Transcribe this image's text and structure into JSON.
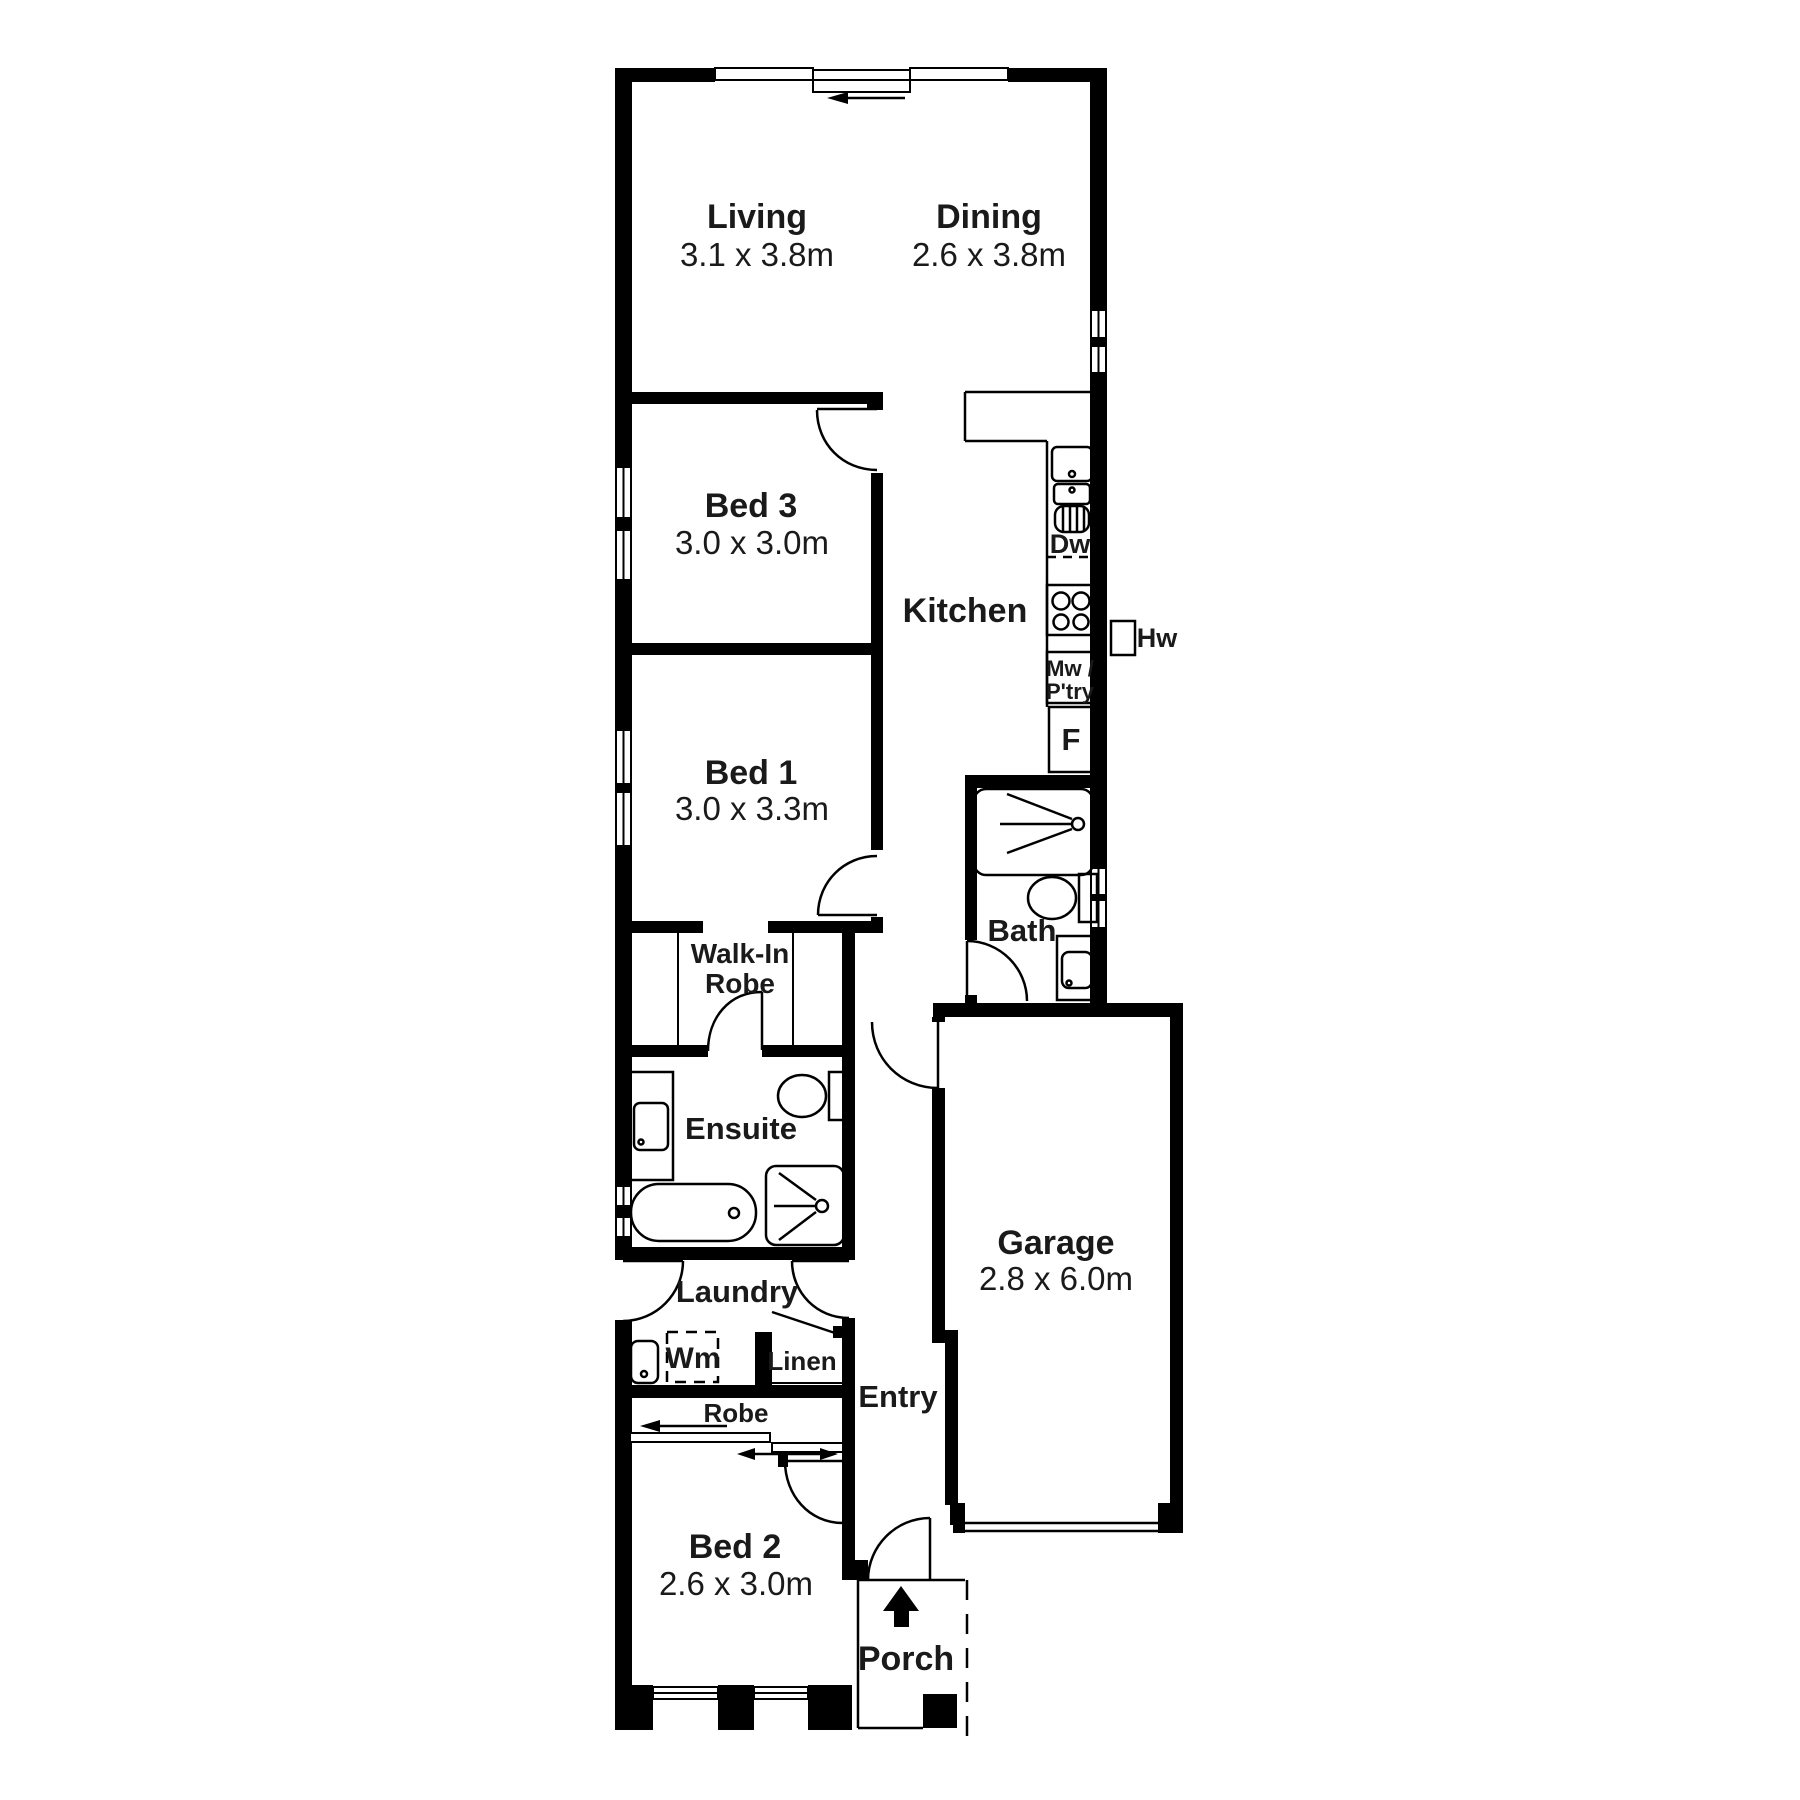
{
  "document": {
    "type": "floor-plan",
    "background": "#ffffff",
    "wall_color": "#000000",
    "text_color": "#1a1a1a"
  },
  "rooms": [
    {
      "name": "Living",
      "dimensions": "3.1 x 3.8m"
    },
    {
      "name": "Dining",
      "dimensions": "2.6 x 3.8m"
    },
    {
      "name": "Bed 3",
      "dimensions": "3.0 x 3.0m"
    },
    {
      "name": "Kitchen",
      "dimensions": ""
    },
    {
      "name": "Bed 1",
      "dimensions": "3.0 x 3.3m"
    },
    {
      "name": "Walk-In Robe",
      "dimensions": ""
    },
    {
      "name": "Bath",
      "dimensions": ""
    },
    {
      "name": "Ensuite",
      "dimensions": ""
    },
    {
      "name": "Garage",
      "dimensions": "2.8 x 6.0m"
    },
    {
      "name": "Laundry",
      "dimensions": ""
    },
    {
      "name": "Linen",
      "dimensions": ""
    },
    {
      "name": "Entry",
      "dimensions": ""
    },
    {
      "name": "Bed 2",
      "dimensions": "2.6 x 3.0m"
    },
    {
      "name": "Porch",
      "dimensions": ""
    }
  ],
  "fixture_labels": {
    "dishwasher": "Dw",
    "microwave_pantry": "Mw / P'try",
    "fridge": "F",
    "hot_water": "Hw",
    "washing_machine": "Wm",
    "robe": "Robe"
  },
  "labels": [
    {
      "id": "living-name",
      "text": "Living",
      "x": 757,
      "y": 228,
      "size": 34,
      "weight": 700
    },
    {
      "id": "living-dims",
      "text": "3.1 x 3.8m",
      "x": 757,
      "y": 266,
      "size": 33,
      "weight": 400
    },
    {
      "id": "dining-name",
      "text": "Dining",
      "x": 989,
      "y": 228,
      "size": 34,
      "weight": 700
    },
    {
      "id": "dining-dims",
      "text": "2.6 x 3.8m",
      "x": 989,
      "y": 266,
      "size": 33,
      "weight": 400
    },
    {
      "id": "bed3-name",
      "text": "Bed 3",
      "x": 751,
      "y": 517,
      "size": 34,
      "weight": 700
    },
    {
      "id": "bed3-dims",
      "text": "3.0 x 3.0m",
      "x": 752,
      "y": 554,
      "size": 33,
      "weight": 400
    },
    {
      "id": "kitchen-name",
      "text": "Kitchen",
      "x": 965,
      "y": 622,
      "size": 34,
      "weight": 700
    },
    {
      "id": "bed1-name",
      "text": "Bed 1",
      "x": 751,
      "y": 784,
      "size": 34,
      "weight": 700
    },
    {
      "id": "bed1-dims",
      "text": "3.0 x 3.3m",
      "x": 752,
      "y": 820,
      "size": 33,
      "weight": 400
    },
    {
      "id": "wir-line1",
      "text": "Walk-In",
      "x": 740,
      "y": 963,
      "size": 28,
      "weight": 700
    },
    {
      "id": "wir-line2",
      "text": "Robe",
      "x": 740,
      "y": 993,
      "size": 28,
      "weight": 700
    },
    {
      "id": "bath-name",
      "text": "Bath",
      "x": 1022,
      "y": 941,
      "size": 31,
      "weight": 700
    },
    {
      "id": "ensuite-name",
      "text": "Ensuite",
      "x": 741,
      "y": 1139,
      "size": 31,
      "weight": 700
    },
    {
      "id": "garage-name",
      "text": "Garage",
      "x": 1056,
      "y": 1254,
      "size": 34,
      "weight": 700
    },
    {
      "id": "garage-dims",
      "text": "2.8 x 6.0m",
      "x": 1056,
      "y": 1290,
      "size": 33,
      "weight": 400
    },
    {
      "id": "laundry-name",
      "text": "Laundry",
      "x": 737,
      "y": 1302,
      "size": 31,
      "weight": 700
    },
    {
      "id": "wm-label",
      "text": "Wm",
      "x": 693,
      "y": 1368,
      "size": 30,
      "weight": 700
    },
    {
      "id": "linen-label",
      "text": "Linen",
      "x": 802,
      "y": 1370,
      "size": 26,
      "weight": 700
    },
    {
      "id": "robe-label",
      "text": "Robe",
      "x": 736,
      "y": 1422,
      "size": 26,
      "weight": 700
    },
    {
      "id": "entry-name",
      "text": "Entry",
      "x": 898,
      "y": 1407,
      "size": 31,
      "weight": 700
    },
    {
      "id": "bed2-name",
      "text": "Bed 2",
      "x": 735,
      "y": 1558,
      "size": 34,
      "weight": 700
    },
    {
      "id": "bed2-dims",
      "text": "2.6 x 3.0m",
      "x": 736,
      "y": 1595,
      "size": 33,
      "weight": 400
    },
    {
      "id": "porch-name",
      "text": "Porch",
      "x": 906,
      "y": 1670,
      "size": 34,
      "weight": 700
    },
    {
      "id": "dw-label",
      "text": "Dw",
      "x": 1070,
      "y": 553,
      "size": 27,
      "weight": 700
    },
    {
      "id": "mw-label-1",
      "text": "Mw /",
      "x": 1070,
      "y": 676,
      "size": 22,
      "weight": 700
    },
    {
      "id": "mw-label-2",
      "text": "P'try",
      "x": 1070,
      "y": 699,
      "size": 22,
      "weight": 700
    },
    {
      "id": "f-label",
      "text": "F",
      "x": 1071,
      "y": 750,
      "size": 31,
      "weight": 700
    },
    {
      "id": "hw-label",
      "text": "Hw",
      "x": 1157,
      "y": 647,
      "size": 27,
      "weight": 700
    }
  ]
}
